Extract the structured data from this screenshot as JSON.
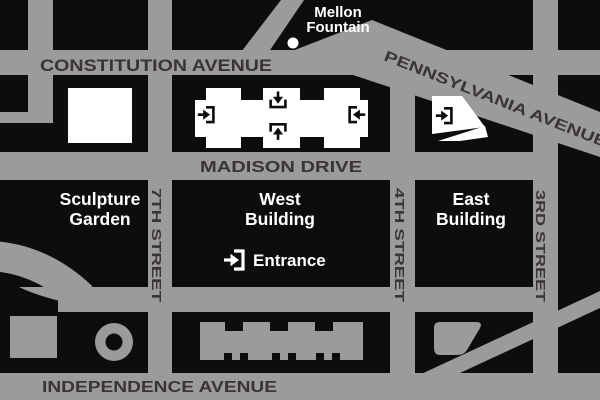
{
  "map_title": "National Gallery of Art area map",
  "colors": {
    "street_gray": "#9b9a9c",
    "block_black": "#0c0d0f",
    "street_text": "#3a3532",
    "label_white": "#ffffff"
  },
  "streets": {
    "constitution": "CONSTITUTION AVENUE",
    "pennsylvania": "PENNSYLVANIA AVENUE",
    "madison": "MADISON DRIVE",
    "independence": "INDEPENDENCE AVENUE",
    "seventh": "7TH STREET",
    "fourth": "4TH STREET",
    "third": "3RD STREET"
  },
  "landmarks": {
    "mellon_line1": "Mellon",
    "mellon_line2": "Fountain",
    "sculpture_line1": "Sculpture",
    "sculpture_line2": "Garden",
    "west_line1": "West",
    "west_line2": "Building",
    "east_line1": "East",
    "east_line2": "Building",
    "entrance": "Entrance"
  },
  "icons": {
    "entrance_marker": "entrance-arrow-icon",
    "fountain_marker": "fountain-dot"
  }
}
